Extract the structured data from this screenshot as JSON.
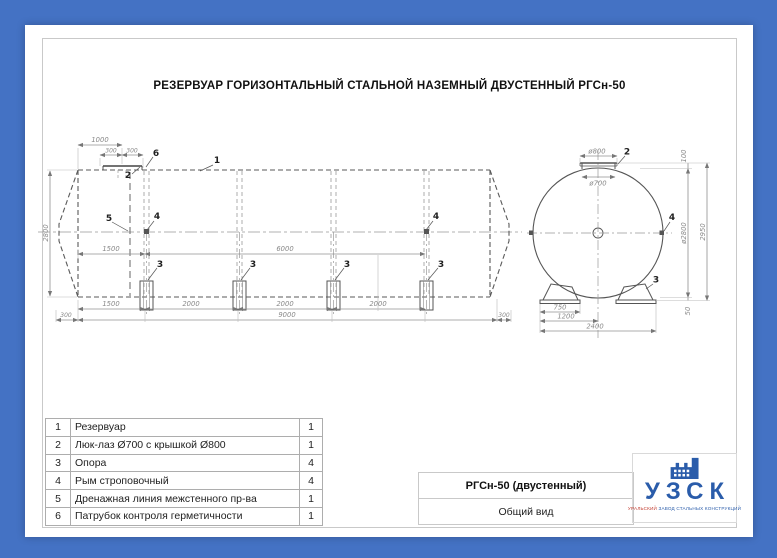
{
  "sheet": {
    "title": "РЕЗЕРВУАР ГОРИЗОНТАЛЬНЫЙ СТАЛЬНОЙ НАЗЕМНЫЙ ДВУСТЕННЫЙ РГСн-50",
    "colors": {
      "background": "#4472c4",
      "paper": "#ffffff",
      "drawing_line": "#555555",
      "dimension_text": "#8a8a8a",
      "logo_blue": "#2a5caa",
      "logo_red": "#c23b2e"
    }
  },
  "side_view": {
    "dims": [
      "1000",
      "300",
      "300",
      "2800",
      "1500",
      "6000",
      "1500",
      "2000",
      "2000",
      "2000",
      "300",
      "9000",
      "300"
    ],
    "refs": [
      "1",
      "2",
      "6",
      "5",
      "4",
      "4",
      "3",
      "3",
      "3",
      "3"
    ]
  },
  "end_view": {
    "dims": [
      "ø800",
      "ø700",
      "100",
      "ø2800",
      "2950",
      "50",
      "750",
      "1200",
      "2400"
    ],
    "refs": [
      "2",
      "4",
      "3"
    ]
  },
  "parts_table": {
    "rows": [
      {
        "num": "1",
        "name": "Резервуар",
        "qty": "1"
      },
      {
        "num": "2",
        "name": "Люк-лаз Ø700 с крышкой Ø800",
        "qty": "1"
      },
      {
        "num": "3",
        "name": "Опора",
        "qty": "4"
      },
      {
        "num": "4",
        "name": "Рым строповочный",
        "qty": "4"
      },
      {
        "num": "5",
        "name": "Дренажная линия межстенного пр-ва",
        "qty": "1"
      },
      {
        "num": "6",
        "name": "Патрубок контроля герметичности",
        "qty": "1"
      }
    ]
  },
  "title_block": {
    "model": "РГСн-50 (двустенный)",
    "view_name": "Общий вид"
  },
  "logo": {
    "acronym": "УЗСК",
    "tagline_word1": "УРАЛЬСКИЙ",
    "tagline_rest": " ЗАВОД СТАЛЬНЫХ КОНСТРУКЦИЙ"
  }
}
